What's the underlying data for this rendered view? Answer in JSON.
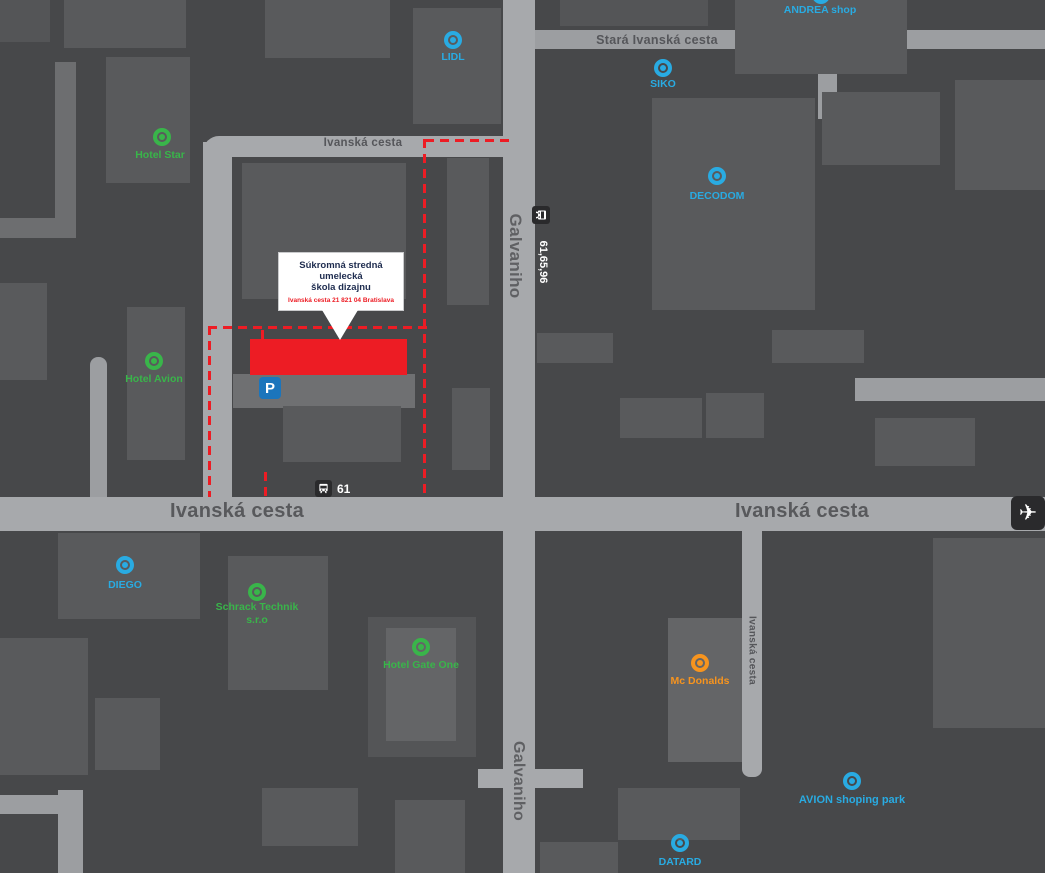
{
  "theme": {
    "background": "#47484a",
    "building": "#595a5c",
    "building_dark": "#545557",
    "building_light": "#646567",
    "road": "#a7a9ac",
    "road_secondary": "#9c9ea1",
    "road_tertiary": "#6d6e70",
    "road_label": "#55565a",
    "cyan": "#29abe2",
    "green": "#39b54a",
    "orange": "#f7941e",
    "red": "#ed1c24",
    "badge_dark": "#2a2a2c",
    "parking_blue": "#1b75bc",
    "callout_title": "#1e2c4f"
  },
  "roads": {
    "stara_ivanska": "Stará Ivanská cesta",
    "ivanska_top": "Ivanská cesta",
    "ivanska_main_left": "Ivanská cesta",
    "ivanska_main_right": "Ivanská cesta",
    "ivanska_small_vertical": "Ivanská cesta",
    "galvaniho_top": "Galvaniho",
    "galvaniho_bottom": "Galvaniho"
  },
  "pois": [
    {
      "id": "lidl",
      "label": "LIDL",
      "color": "cyan"
    },
    {
      "id": "andrea-shop",
      "label": "ANDREA shop",
      "color": "cyan"
    },
    {
      "id": "siko",
      "label": "SIKO",
      "color": "cyan"
    },
    {
      "id": "decodom",
      "label": "DECODOM",
      "color": "cyan"
    },
    {
      "id": "hotel-star",
      "label": "Hotel Star",
      "color": "green"
    },
    {
      "id": "hotel-avion",
      "label": "Hotel Avion",
      "color": "green"
    },
    {
      "id": "diego",
      "label": "DIEGO",
      "color": "cyan"
    },
    {
      "id": "schrack-technik",
      "label": "Schrack Technik",
      "label2": "s.r.o",
      "color": "green"
    },
    {
      "id": "hotel-gate-one",
      "label": "Hotel Gate One",
      "color": "green"
    },
    {
      "id": "mcdonalds",
      "label": "Mc Donalds",
      "color": "orange"
    },
    {
      "id": "avion-shoping-park",
      "label": "AVION shoping park",
      "color": "cyan"
    },
    {
      "id": "datard",
      "label": "DATARD",
      "color": "cyan"
    }
  ],
  "transit": {
    "bus_stop_label": "61",
    "bus_routes_vertical": "61,65,96",
    "parking_label": "P"
  },
  "callout": {
    "title_line1": "Súkromná stredná umelecká",
    "title_line2": "škola dizajnu",
    "address": "Ivanská cesta 21 821 04 Bratislava"
  }
}
